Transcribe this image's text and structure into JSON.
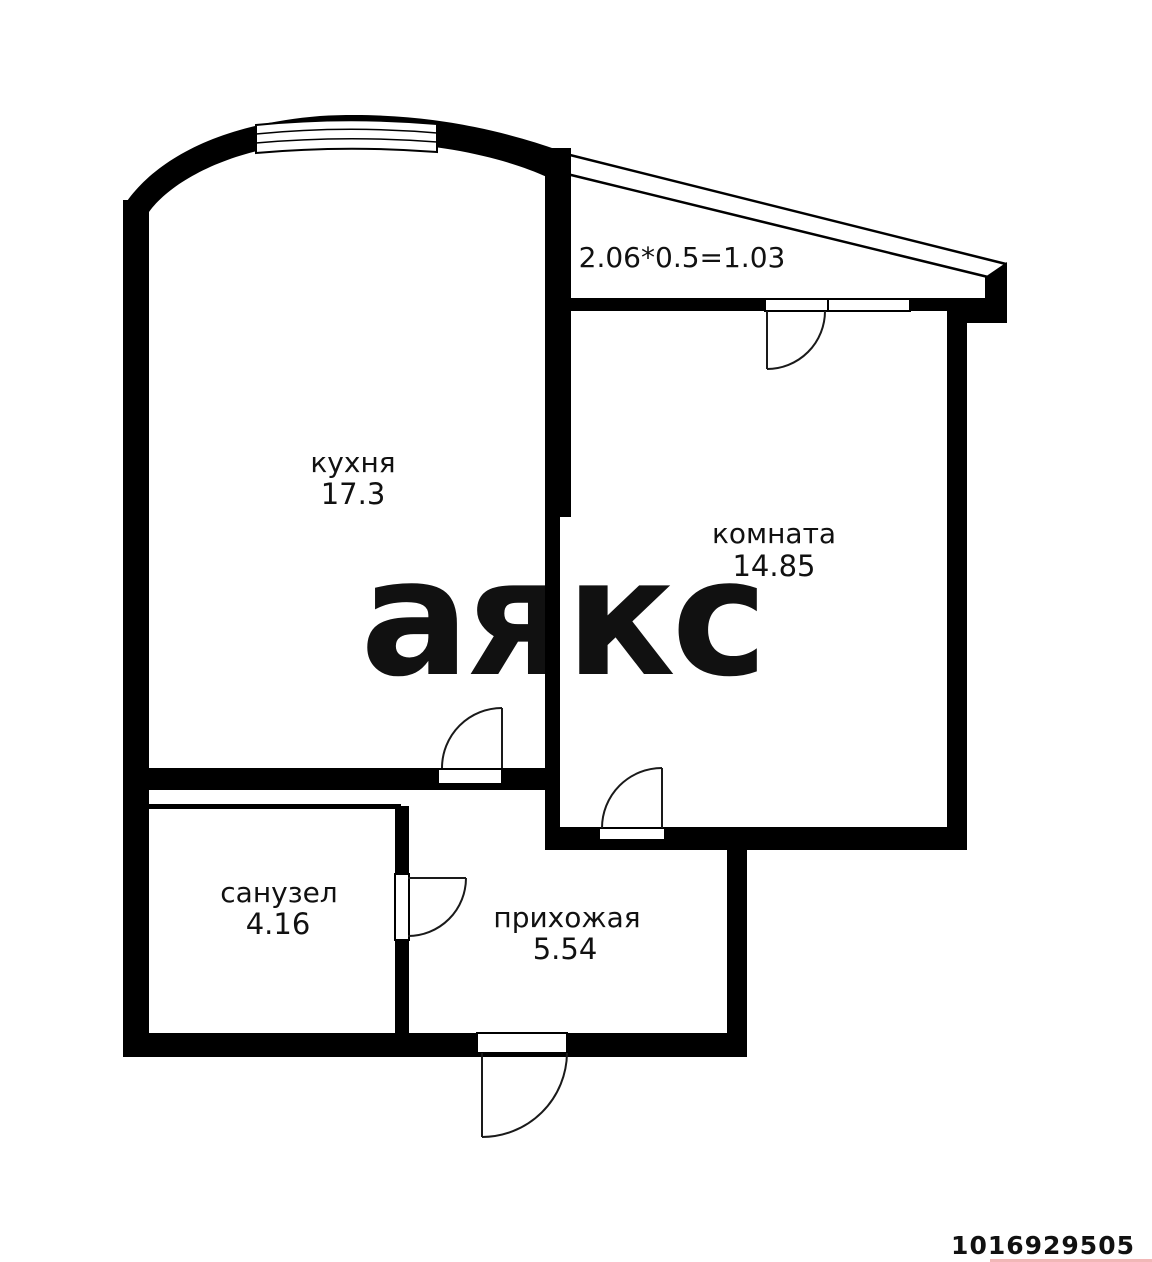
{
  "plan": {
    "watermark": "аякс",
    "listing_id": "1016929505",
    "balcony": {
      "note": "2.06*0.5=1.03"
    },
    "rooms": {
      "kitchen": {
        "label": "кухня",
        "area": "17.3"
      },
      "living": {
        "label": "комната",
        "area": "14.85"
      },
      "bathroom": {
        "label": "санузел",
        "area": "4.16"
      },
      "hallway": {
        "label": "прихожая",
        "area": "5.54"
      }
    },
    "colors": {
      "walls": "#000000",
      "watermark": "#e9e9e9",
      "listing_id_color": "#cc2323",
      "background": "#ffffff"
    }
  }
}
